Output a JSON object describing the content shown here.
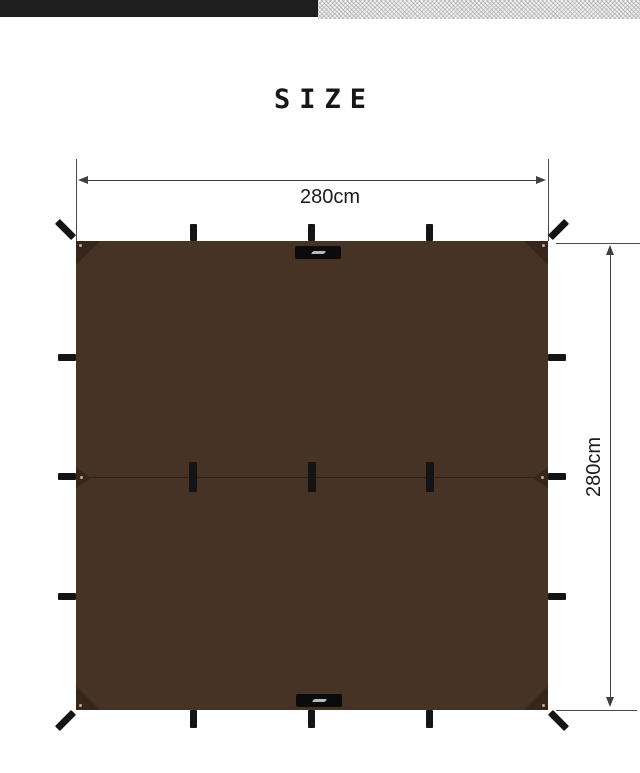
{
  "title": "SIZE",
  "header": {
    "left_bar_color": "#1e1e1e",
    "right_bar_color": "#f2f2f2"
  },
  "diagram": {
    "width_label": "280cm",
    "height_label": "280cm",
    "tarp_color": "#463326",
    "corner_patch_color": "#37271b",
    "loop_color": "#141414",
    "dimension_line_color": "#3f3f3f"
  }
}
